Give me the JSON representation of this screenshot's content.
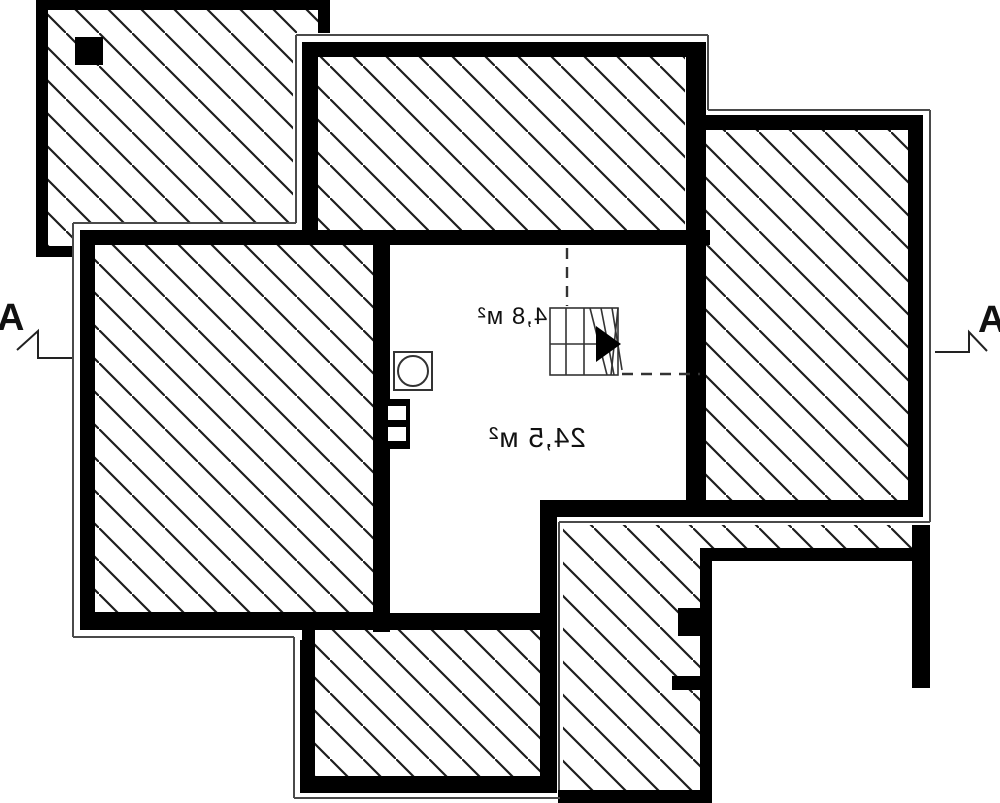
{
  "plan": {
    "type": "floor-plan",
    "labels": {
      "room_main": "24,5 м²",
      "room_stairs": "4,8 м²",
      "section_left": "A",
      "section_right": "A"
    },
    "symbols": {
      "stair": "stair-icon",
      "stair_arrow": "stair-direction-arrow-icon",
      "vent": "vent-circle-icon",
      "chimney_flue": "chimney-flue-icon",
      "roof_hatch": "roof-slope-hatch",
      "section_cut": "section-cut-mark"
    },
    "colors": {
      "background": "#ffffff",
      "wall": "#000000",
      "hatch_line": "#1d1d1d",
      "eave_outline": "#4a4a4a",
      "symbol_line": "#333333",
      "label_text": "#111111"
    }
  }
}
